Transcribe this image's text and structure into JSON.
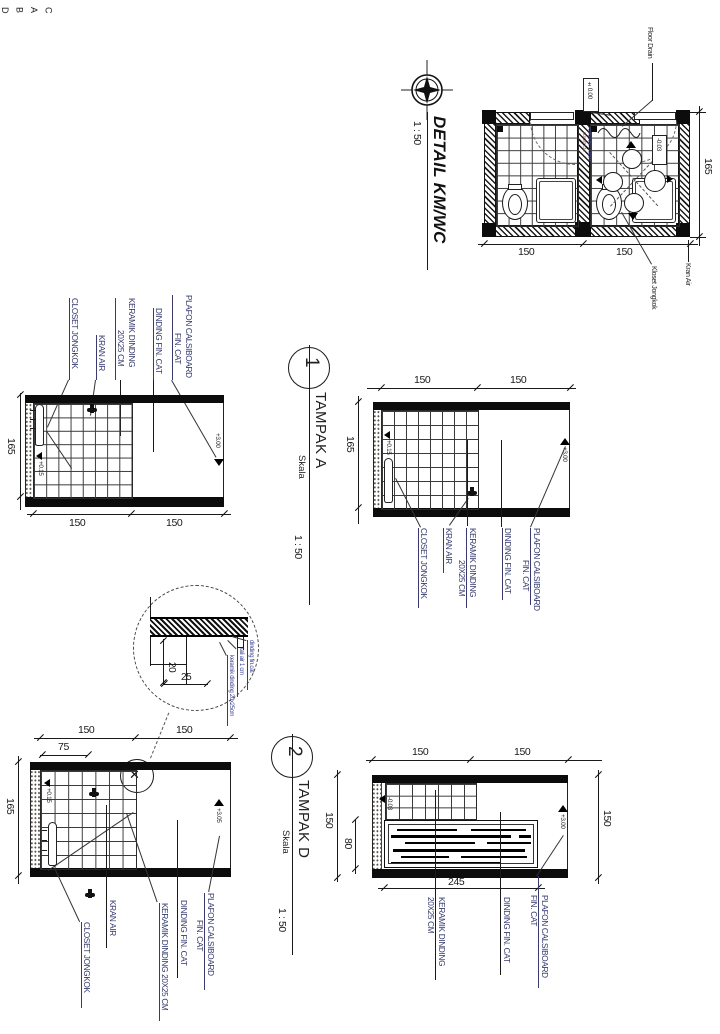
{
  "plan": {
    "title": "DETAIL KM/WC",
    "scale": "1 : 50",
    "floor_drain": "Floor Drain",
    "level_zero": "±0.00",
    "level_room": "-0.03",
    "tile_note_1": "KERAMIK LANTAI",
    "tile_note_2": "20X20 CM",
    "kran_air": "Kran Air",
    "kloset_jongkok": "Kloset Jongkok",
    "dim_w1": "150",
    "dim_w2": "150",
    "dim_h": "165",
    "marker_a": "A",
    "marker_b": "B",
    "marker_c": "C",
    "marker_d": "D"
  },
  "e1": {
    "closet": "CLOSET JONGKOK",
    "kran": "KRAN AIR",
    "keramik_1": "KERAMIK DINDING",
    "keramik_2": "20X25 CM",
    "dinding": "DINDING FIN. CAT",
    "plafon_1": "PLAFON CALSIBOARD",
    "plafon_2": "FIN. CAT",
    "lvl_floor": "+0.15",
    "lvl_ceiling": "+3.00",
    "dim_h": "165",
    "dim_w1": "150",
    "dim_w2": "150"
  },
  "ta": {
    "num": "1",
    "title": "TAMPAK A",
    "skala": "Skala",
    "scale": "1 : 50",
    "closet": "CLOSET JONGKOK",
    "kran": "KRAN AIR",
    "keramik_1": "KERAMIK DINDING",
    "keramik_2": "20X25 CM",
    "dinding": "DINDING FIN. CAT",
    "plafon_1": "PLAFON CALSIBOARD",
    "plafon_2": "FIN. CAT",
    "lvl_floor": "+0.15",
    "lvl_ceiling": "+3.00",
    "dim_w1": "150",
    "dim_w2": "150",
    "dim_h": "165"
  },
  "dc": {
    "dim_20": "20",
    "dim_25": "25",
    "l1": "dinding fin.cat",
    "l2": "tali air 1 cm",
    "l3": "keramik dinding 20x25cm"
  },
  "e3": {
    "closet": "CLOSET JONGKOK",
    "kran": "KRAN AIR",
    "keramik": "KERAMIK DINDING 20X25 CM",
    "dinding": "DINDING FIN. CAT",
    "plafon_1": "PLAFON CALSIBOARD",
    "plafon_2": "FIN. CAT",
    "lvl_floor": "+0.15",
    "lvl_ceiling": "+3.05",
    "xmark": "✕",
    "dim_w1": "150",
    "dim_w2": "150",
    "dim_w3": "75",
    "dim_h": "165"
  },
  "td": {
    "num": "2",
    "title": "TAMPAK D",
    "skala": "Skala",
    "scale": "1 : 50",
    "keramik_1": "KERAMIK DINDING",
    "keramik_2": "20X25 CM",
    "dinding": "DINDING FIN. CAT",
    "plafon_1": "PLAFON CALSIBOARD",
    "plafon_2": "FIN. CAT",
    "lvl_floor": "-0.03",
    "lvl_ceiling": "+3.00",
    "dim_top1": "150",
    "dim_top2": "150",
    "dim_left1": "150",
    "dim_left2": "80",
    "dim_right": "150",
    "dim_bottom": "245"
  }
}
